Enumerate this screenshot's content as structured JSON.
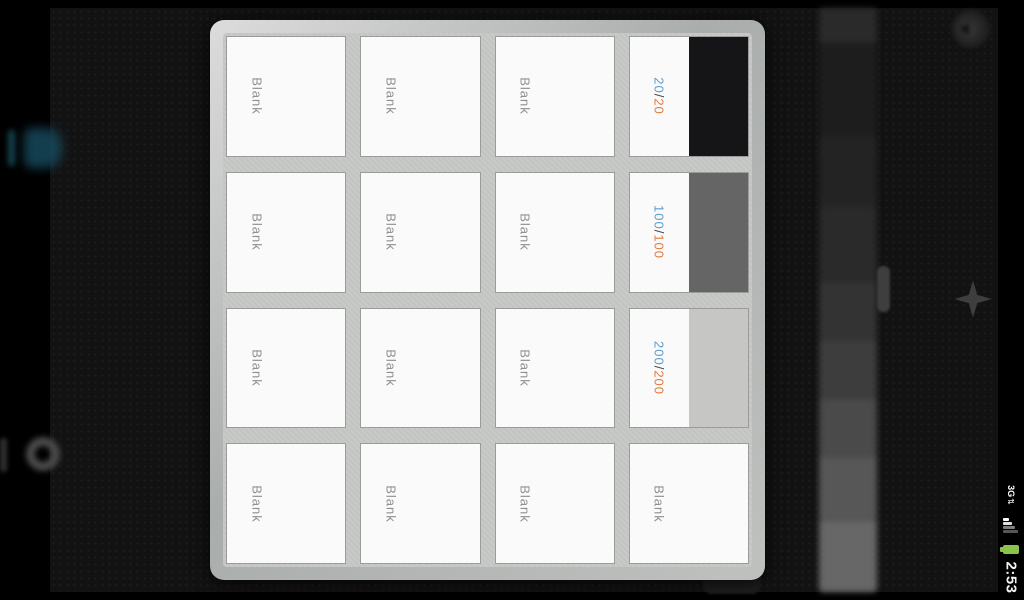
{
  "colors": {
    "fg_number": "#5b9dc9",
    "separator": "#3f3f3f",
    "bg_number": "#e2793b",
    "blank_label": "#8f8f8f",
    "battery": "#8bc34a"
  },
  "picker": {
    "pages": [
      {
        "type": "blank",
        "label": "Blank"
      },
      {
        "type": "blank",
        "label": "Blank"
      },
      {
        "type": "blank",
        "label": "Blank"
      },
      {
        "type": "contrast",
        "fg": "20",
        "separator": "/",
        "bg": "20",
        "swatch": "#151517"
      },
      {
        "type": "blank",
        "label": "Blank"
      },
      {
        "type": "blank",
        "label": "Blank"
      },
      {
        "type": "blank",
        "label": "Blank"
      },
      {
        "type": "contrast",
        "fg": "100",
        "separator": "/",
        "bg": "100",
        "swatch": "#656565"
      },
      {
        "type": "blank",
        "label": "Blank"
      },
      {
        "type": "blank",
        "label": "Blank"
      },
      {
        "type": "blank",
        "label": "Blank"
      },
      {
        "type": "contrast",
        "fg": "200",
        "separator": "/",
        "bg": "200",
        "swatch": "#c6c6c4"
      },
      {
        "type": "blank",
        "label": "Blank"
      },
      {
        "type": "blank",
        "label": "Blank"
      },
      {
        "type": "blank",
        "label": "Blank"
      },
      {
        "type": "blank",
        "label": "Blank"
      }
    ]
  },
  "status_bar": {
    "network_label": "3G",
    "network_arrows": "⇅",
    "clock": "2:53"
  }
}
